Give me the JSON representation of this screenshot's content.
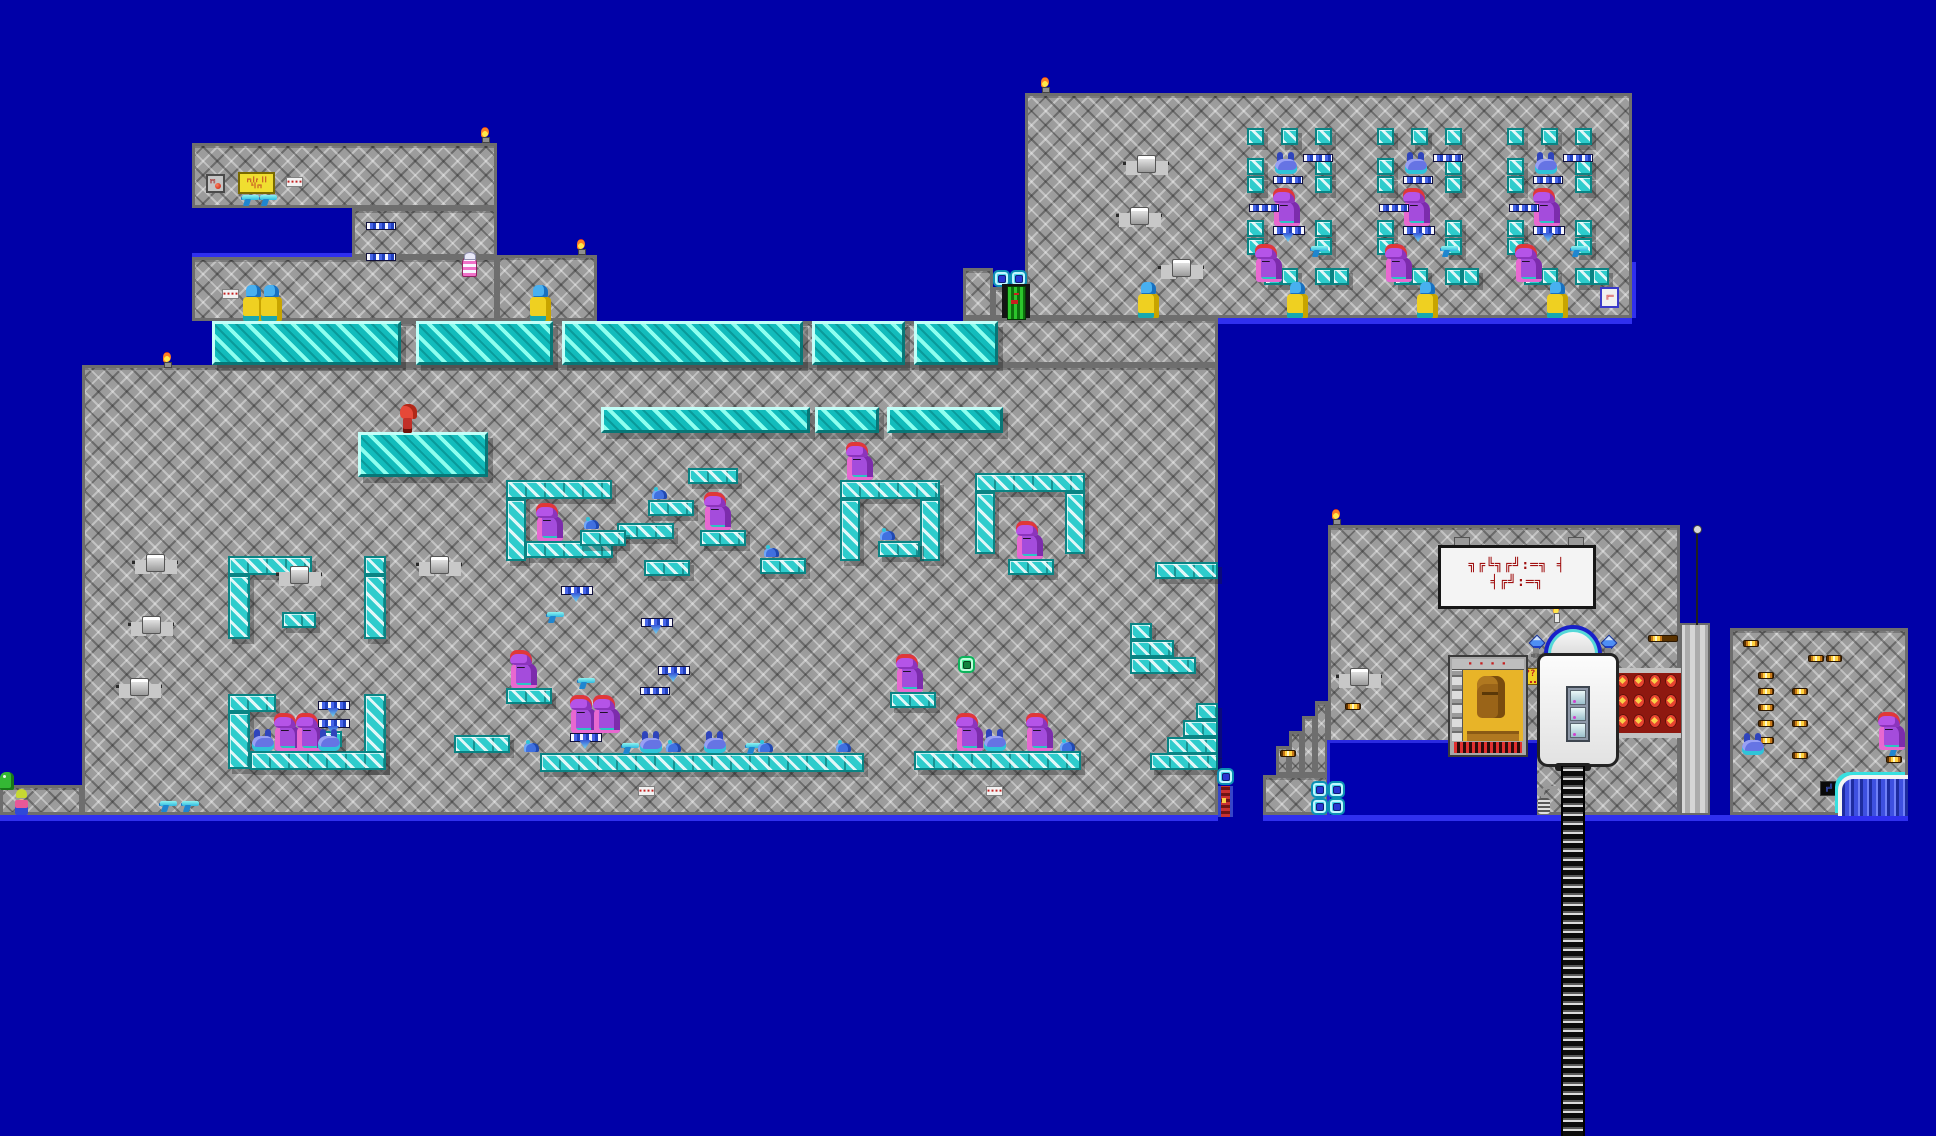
{
  "scene": "alien-base side-view level map",
  "palette": {
    "background": "#0000A8",
    "floor_highlight": "#2F2FEF",
    "terrain_tile": "#9C9C9C",
    "glass_block": "#2ECCCC",
    "striped_platform": "#12BCBC",
    "sign_text_red": "#A01010",
    "gold_item": "#FFD23F"
  },
  "right_area": {
    "guard_sign": {
      "line1": "╗╔╚╗╔╝:═╗ ╡",
      "line2": "╡╔╝:═╗"
    },
    "monitor": {
      "top_dashes": "▪ ▪ ▪ ▪"
    },
    "dot_wall": {
      "rows": 3,
      "cols": 4
    }
  },
  "map": {
    "regions": [
      {
        "x": 192,
        "y": 143,
        "w": 305,
        "h": 65
      },
      {
        "x": 352,
        "y": 208,
        "w": 145,
        "h": 49
      },
      {
        "x": 192,
        "y": 257,
        "w": 305,
        "h": 64
      },
      {
        "x": 497,
        "y": 255,
        "w": 100,
        "h": 66
      },
      {
        "x": 212,
        "y": 321,
        "w": 786,
        "h": 44
      },
      {
        "x": 963,
        "y": 268,
        "w": 30,
        "h": 50
      },
      {
        "x": 993,
        "y": 287,
        "w": 35,
        "h": 31
      },
      {
        "x": 963,
        "y": 318,
        "w": 255,
        "h": 47
      },
      {
        "x": 82,
        "y": 365,
        "w": 1136,
        "h": 450
      },
      {
        "x": 0,
        "y": 785,
        "w": 82,
        "h": 30
      },
      {
        "x": 1025,
        "y": 93,
        "w": 607,
        "h": 225
      },
      {
        "x": 1328,
        "y": 525,
        "w": 352,
        "h": 290
      },
      {
        "x": 1730,
        "y": 628,
        "w": 178,
        "h": 187
      },
      {
        "x": 1263,
        "y": 775,
        "w": 66,
        "h": 40
      },
      {
        "x": 1315,
        "y": 701,
        "w": 13,
        "h": 74
      },
      {
        "x": 1302,
        "y": 716,
        "w": 13,
        "h": 59
      },
      {
        "x": 1289,
        "y": 731,
        "w": 13,
        "h": 44
      },
      {
        "x": 1276,
        "y": 746,
        "w": 13,
        "h": 29
      },
      {
        "x": 1680,
        "y": 623,
        "w": 30,
        "h": 192,
        "k": "light"
      },
      {
        "x": 1327,
        "y": 740,
        "w": 210,
        "h": 75,
        "k": "pedestal"
      }
    ],
    "floor_lines": [
      {
        "x": 192,
        "y": 253,
        "w": 160,
        "h": 4
      },
      {
        "x": 1218,
        "y": 318,
        "w": 414,
        "h": 6
      },
      {
        "x": 82,
        "y": 815,
        "w": 1136,
        "h": 6
      },
      {
        "x": 0,
        "y": 815,
        "w": 82,
        "h": 6
      },
      {
        "x": 1263,
        "y": 815,
        "w": 645,
        "h": 6
      },
      {
        "x": 1632,
        "y": 262,
        "w": 4,
        "h": 56
      }
    ],
    "big_bars": [
      [
        212,
        321,
        189,
        44
      ],
      [
        416,
        321,
        137,
        44
      ],
      [
        562,
        321,
        241,
        44
      ],
      [
        812,
        321,
        93,
        44
      ],
      [
        914,
        321,
        84,
        44
      ],
      [
        358,
        432,
        130,
        45
      ]
    ],
    "thin_bars": [
      [
        601,
        407,
        209,
        26
      ],
      [
        815,
        407,
        64,
        26
      ],
      [
        887,
        407,
        116,
        26
      ]
    ],
    "glass": [
      [
        228,
        556,
        84,
        19
      ],
      [
        364,
        556,
        22,
        19
      ],
      [
        228,
        575,
        22,
        64
      ],
      [
        364,
        575,
        22,
        64
      ],
      [
        282,
        612,
        34,
        16
      ],
      [
        228,
        694,
        48,
        18
      ],
      [
        364,
        694,
        22,
        76
      ],
      [
        228,
        712,
        22,
        57
      ],
      [
        250,
        751,
        136,
        19
      ],
      [
        306,
        731,
        36,
        16
      ],
      [
        506,
        480,
        106,
        19
      ],
      [
        506,
        499,
        20,
        62
      ],
      [
        525,
        541,
        88,
        17
      ],
      [
        617,
        523,
        57,
        16
      ],
      [
        688,
        468,
        50,
        16
      ],
      [
        648,
        500,
        46,
        16
      ],
      [
        580,
        530,
        46,
        16
      ],
      [
        700,
        530,
        46,
        16
      ],
      [
        644,
        560,
        46,
        16
      ],
      [
        760,
        558,
        46,
        16
      ],
      [
        1008,
        559,
        46,
        16
      ],
      [
        506,
        688,
        46,
        16
      ],
      [
        890,
        692,
        46,
        16
      ],
      [
        840,
        480,
        100,
        19
      ],
      [
        840,
        499,
        20,
        62
      ],
      [
        920,
        499,
        20,
        62
      ],
      [
        878,
        541,
        42,
        16
      ],
      [
        975,
        473,
        110,
        19
      ],
      [
        975,
        492,
        20,
        62
      ],
      [
        1065,
        492,
        20,
        62
      ],
      [
        540,
        753,
        324,
        19
      ],
      [
        914,
        751,
        167,
        19
      ],
      [
        454,
        735,
        56,
        18
      ],
      [
        1155,
        562,
        63,
        17
      ],
      [
        1130,
        623,
        22,
        17
      ],
      [
        1130,
        640,
        44,
        17
      ],
      [
        1130,
        657,
        66,
        17
      ],
      [
        1196,
        703,
        22,
        17
      ],
      [
        1183,
        720,
        35,
        17
      ],
      [
        1167,
        737,
        51,
        17
      ],
      [
        1150,
        753,
        68,
        17
      ]
    ],
    "clusters": {
      "positions": [
        [
          1247,
          128
        ],
        [
          1377,
          128
        ],
        [
          1507,
          128
        ]
      ],
      "layout": {
        "glass": [
          [
            0,
            0
          ],
          [
            34,
            0
          ],
          [
            68,
            0
          ],
          [
            0,
            30
          ],
          [
            0,
            48
          ],
          [
            68,
            30
          ],
          [
            68,
            48
          ],
          [
            0,
            92
          ],
          [
            0,
            110
          ],
          [
            68,
            92
          ],
          [
            68,
            110
          ],
          [
            17,
            140
          ],
          [
            34,
            140
          ],
          [
            68,
            140
          ],
          [
            85,
            140
          ]
        ],
        "sprites": [
          {
            "t": "round-alien",
            "x": 28,
            "y": 24
          },
          {
            "t": "striped-bar",
            "x": 56,
            "y": 26
          },
          {
            "t": "striped-bar",
            "x": 26,
            "y": 48
          },
          {
            "t": "dog-alien",
            "x": 26,
            "y": 60
          },
          {
            "t": "striped-bar",
            "x": 2,
            "y": 76
          },
          {
            "t": "claw-platform",
            "x": 26,
            "y": 98
          },
          {
            "t": "dog-alien",
            "x": 8,
            "y": 116
          },
          {
            "t": "stunner-pickup",
            "x": 62,
            "y": 116
          }
        ]
      }
    },
    "items": [
      {
        "t": "sign-security",
        "x": 206,
        "y": 174,
        "text": "╔╗"
      },
      {
        "t": "sign-yellow",
        "x": 238,
        "y": 172,
        "text": "╔╗║╔ ║║\n╚║╔╗"
      },
      {
        "t": "sign-dots",
        "x": 286,
        "y": 177,
        "text": "▪▪▪▪"
      },
      {
        "t": "sign-dots",
        "x": 222,
        "y": 289,
        "text": "▪▪▪▪"
      },
      {
        "t": "sign-dots",
        "x": 638,
        "y": 786,
        "text": "▪▪▪▪"
      },
      {
        "t": "sign-dots",
        "x": 986,
        "y": 786,
        "text": "▪▪▪▪"
      },
      {
        "t": "plaque",
        "x": 1600,
        "y": 287,
        "text": "╔═"
      },
      {
        "t": "sign-qm",
        "x": 1522,
        "y": 668,
        "text": "??"
      },
      {
        "t": "sign-black",
        "x": 1820,
        "y": 781,
        "text": "╔╝"
      },
      {
        "t": "stunner-pickup",
        "x": 240,
        "y": 193
      },
      {
        "t": "stunner-pickup",
        "x": 258,
        "y": 193
      },
      {
        "t": "stunner-pickup",
        "x": 158,
        "y": 799
      },
      {
        "t": "stunner-pickup",
        "x": 180,
        "y": 799
      },
      {
        "t": "stunner-pickup",
        "x": 545,
        "y": 610
      },
      {
        "t": "stunner-pickup",
        "x": 576,
        "y": 676
      },
      {
        "t": "stunner-pickup",
        "x": 620,
        "y": 741
      },
      {
        "t": "stunner-pickup",
        "x": 744,
        "y": 741
      },
      {
        "t": "stunner-pickup",
        "x": 1886,
        "y": 743
      },
      {
        "t": "gold-bar-item",
        "x": 1743,
        "y": 640
      },
      {
        "t": "gold-bar-item",
        "x": 1808,
        "y": 655
      },
      {
        "t": "gold-bar-item",
        "x": 1826,
        "y": 655
      },
      {
        "t": "gold-bar-item",
        "x": 1758,
        "y": 672
      },
      {
        "t": "gold-bar-item",
        "x": 1758,
        "y": 688
      },
      {
        "t": "gold-bar-item",
        "x": 1792,
        "y": 688
      },
      {
        "t": "gold-bar-item",
        "x": 1758,
        "y": 704
      },
      {
        "t": "gold-bar-item",
        "x": 1758,
        "y": 720
      },
      {
        "t": "gold-bar-item",
        "x": 1792,
        "y": 720
      },
      {
        "t": "gold-bar-item",
        "x": 1758,
        "y": 737
      },
      {
        "t": "gold-bar-item",
        "x": 1792,
        "y": 752
      },
      {
        "t": "gold-bar-item",
        "x": 1886,
        "y": 756
      },
      {
        "t": "gold-bar-item",
        "x": 1280,
        "y": 750
      },
      {
        "t": "gold-bar-item",
        "x": 1345,
        "y": 703
      },
      {
        "t": "gold-bar-item",
        "x": 1648,
        "y": 635,
        "w": 30
      },
      {
        "t": "wall-switch",
        "x": 1123,
        "y": 155
      },
      {
        "t": "wall-switch",
        "x": 1116,
        "y": 207
      },
      {
        "t": "wall-switch",
        "x": 1158,
        "y": 259
      },
      {
        "t": "wall-switch",
        "x": 132,
        "y": 554
      },
      {
        "t": "wall-switch",
        "x": 128,
        "y": 616
      },
      {
        "t": "wall-switch",
        "x": 116,
        "y": 678
      },
      {
        "t": "wall-switch",
        "x": 276,
        "y": 566
      },
      {
        "t": "wall-switch",
        "x": 416,
        "y": 556
      },
      {
        "t": "wall-switch",
        "x": 1336,
        "y": 668
      },
      {
        "t": "torch-flame",
        "x": 480,
        "y": 127
      },
      {
        "t": "torch-flame",
        "x": 576,
        "y": 239
      },
      {
        "t": "torch-flame",
        "x": 1040,
        "y": 77
      },
      {
        "t": "torch-flame",
        "x": 162,
        "y": 352
      },
      {
        "t": "torch-flame",
        "x": 1331,
        "y": 509
      },
      {
        "t": "candle",
        "x": 1552,
        "y": 605
      },
      {
        "t": "crystal-lamp",
        "x": 1528,
        "y": 637
      },
      {
        "t": "crystal-lamp",
        "x": 1600,
        "y": 637
      },
      {
        "t": "sparkle-star",
        "x": 1561,
        "y": 635
      },
      {
        "t": "pipe-coil",
        "x": 1541,
        "y": 786
      },
      {
        "t": "antenna",
        "x": 1693,
        "y": 525
      },
      {
        "t": "elevator-platform",
        "x": 366,
        "y": 222
      },
      {
        "t": "elevator-platform",
        "x": 366,
        "y": 253
      },
      {
        "t": "claw-platform",
        "x": 318,
        "y": 701
      },
      {
        "t": "claw-platform",
        "x": 318,
        "y": 719
      },
      {
        "t": "claw-platform",
        "x": 561,
        "y": 586
      },
      {
        "t": "claw-platform",
        "x": 641,
        "y": 618
      },
      {
        "t": "claw-platform",
        "x": 658,
        "y": 666
      },
      {
        "t": "claw-platform",
        "x": 570,
        "y": 733
      },
      {
        "t": "striped-bar",
        "x": 640,
        "y": 687
      },
      {
        "t": "gem-socket",
        "x": 993,
        "y": 270
      },
      {
        "t": "gem-socket",
        "x": 1010,
        "y": 270
      },
      {
        "t": "door-green",
        "x": 1002,
        "y": 284
      },
      {
        "t": "gem-socket",
        "x": 1217,
        "y": 768
      },
      {
        "t": "door-red",
        "x": 1218,
        "y": 786
      },
      {
        "t": "gem-socket",
        "x": 1311,
        "y": 781
      },
      {
        "t": "gem-socket",
        "x": 1328,
        "y": 781
      },
      {
        "t": "gem-socket",
        "x": 1311,
        "y": 798
      },
      {
        "t": "gem-socket",
        "x": 1328,
        "y": 798
      },
      {
        "t": "gem-socket-green",
        "x": 958,
        "y": 656
      },
      {
        "t": "worker-alien",
        "x": 243,
        "y": 285
      },
      {
        "t": "worker-alien",
        "x": 261,
        "y": 285
      },
      {
        "t": "worker-alien",
        "x": 530,
        "y": 285
      },
      {
        "t": "worker-alien",
        "x": 1138,
        "y": 282
      },
      {
        "t": "worker-alien",
        "x": 1287,
        "y": 282
      },
      {
        "t": "worker-alien",
        "x": 1417,
        "y": 282
      },
      {
        "t": "worker-alien",
        "x": 1547,
        "y": 282
      },
      {
        "t": "dog-alien",
        "x": 536,
        "y": 503
      },
      {
        "t": "dog-alien",
        "x": 704,
        "y": 492
      },
      {
        "t": "dog-alien",
        "x": 1016,
        "y": 521
      },
      {
        "t": "dog-alien",
        "x": 846,
        "y": 442
      },
      {
        "t": "dog-alien",
        "x": 510,
        "y": 650
      },
      {
        "t": "dog-alien",
        "x": 896,
        "y": 654
      },
      {
        "t": "dog-alien",
        "x": 274,
        "y": 713
      },
      {
        "t": "dog-alien",
        "x": 296,
        "y": 713
      },
      {
        "t": "dog-alien",
        "x": 570,
        "y": 695
      },
      {
        "t": "dog-alien",
        "x": 593,
        "y": 695
      },
      {
        "t": "dog-alien",
        "x": 956,
        "y": 713
      },
      {
        "t": "dog-alien",
        "x": 1026,
        "y": 713
      },
      {
        "t": "dog-alien",
        "x": 1878,
        "y": 712
      },
      {
        "t": "round-alien",
        "x": 252,
        "y": 729
      },
      {
        "t": "round-alien",
        "x": 318,
        "y": 729
      },
      {
        "t": "round-alien",
        "x": 640,
        "y": 731
      },
      {
        "t": "round-alien",
        "x": 704,
        "y": 731
      },
      {
        "t": "round-alien",
        "x": 984,
        "y": 729
      },
      {
        "t": "round-alien",
        "x": 1742,
        "y": 733
      },
      {
        "t": "red-alien",
        "x": 400,
        "y": 404
      },
      {
        "t": "rocket-critter",
        "x": 462,
        "y": 256
      },
      {
        "t": "keen-player",
        "x": 14,
        "y": 789
      },
      {
        "t": "green-critter",
        "x": 0,
        "y": 772
      },
      {
        "t": "small-critter",
        "x": 524,
        "y": 743
      },
      {
        "t": "small-critter",
        "x": 666,
        "y": 743
      },
      {
        "t": "small-critter",
        "x": 758,
        "y": 743
      },
      {
        "t": "small-critter",
        "x": 836,
        "y": 743
      },
      {
        "t": "small-critter",
        "x": 1060,
        "y": 742
      },
      {
        "t": "small-critter",
        "x": 584,
        "y": 520
      },
      {
        "t": "small-critter",
        "x": 652,
        "y": 490
      },
      {
        "t": "small-critter",
        "x": 880,
        "y": 531
      },
      {
        "t": "small-critter",
        "x": 764,
        "y": 548
      }
    ]
  }
}
